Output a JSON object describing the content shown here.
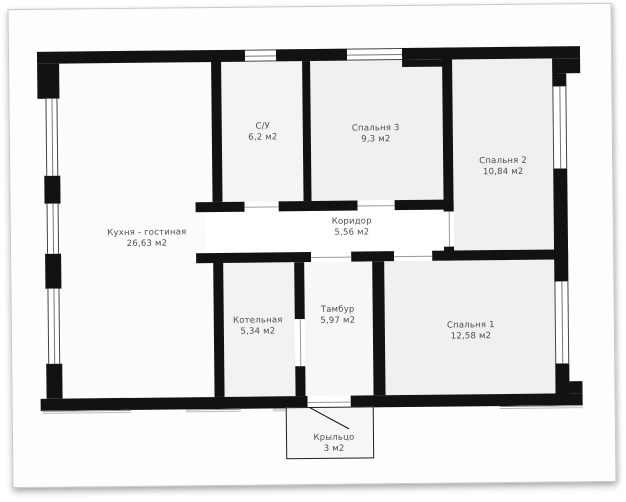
{
  "rooms": {
    "kitchen": {
      "name": "Кухня - гостиная",
      "area": "26,63 м2"
    },
    "bathroom": {
      "name": "С/У",
      "area": "6,2 м2"
    },
    "bedroom3": {
      "name": "Спальня 3",
      "area": "9,3 м2"
    },
    "bedroom2": {
      "name": "Спальня 2",
      "area": "10,84 м2"
    },
    "corridor": {
      "name": "Коридор",
      "area": "5,56 м2"
    },
    "boiler": {
      "name": "Котельная",
      "area": "5,34 м2"
    },
    "tambour": {
      "name": "Тамбур",
      "area": "5,97 м2"
    },
    "bedroom1": {
      "name": "Спальня 1",
      "area": "12,58 м2"
    },
    "porch": {
      "name": "Крыльцо",
      "area": "3 м2"
    }
  },
  "colors": {
    "wall": "#121212",
    "room_fill": "#f0f0f0",
    "corridor_fill": "#ffffff",
    "label_text": "#4d4d4d",
    "page_border": "#c9c9c9"
  }
}
